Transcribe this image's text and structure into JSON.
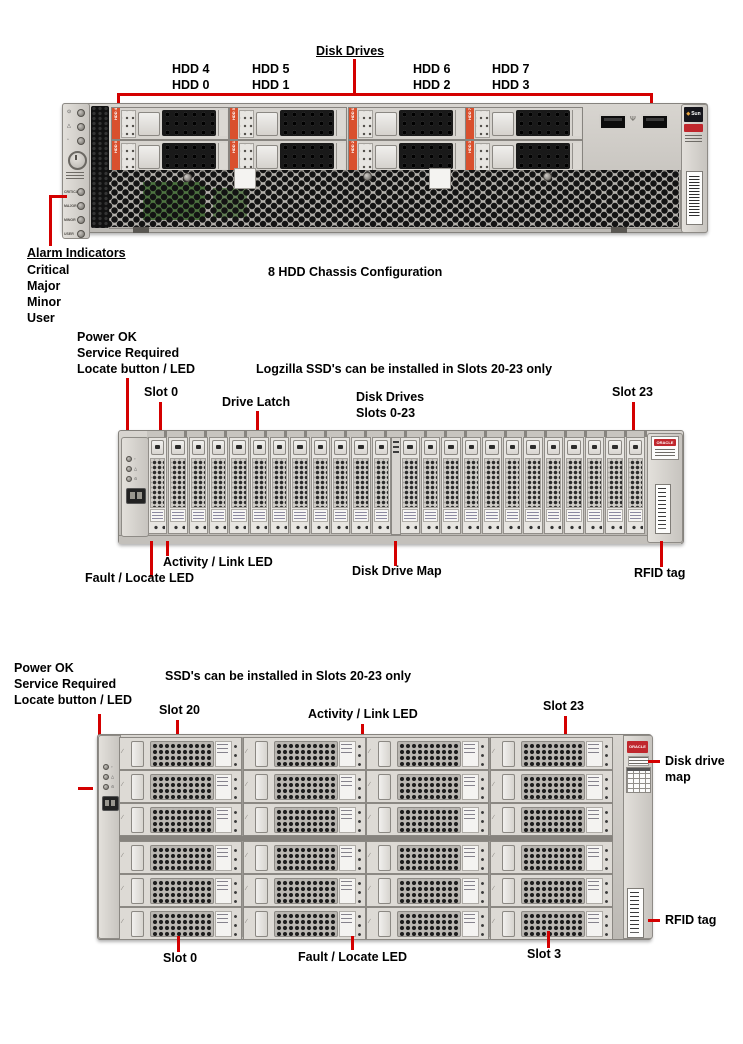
{
  "palette": {
    "leader_red": "#d40000",
    "orange_slot_tag": "#d9502e",
    "oracle_red": "#c0272d",
    "chassis_grey": "#c9c6c1"
  },
  "top": {
    "title": "Disk Drives",
    "hdd_top": [
      "HDD 4",
      "HDD 5",
      "HDD 6",
      "HDD 7"
    ],
    "hdd_bottom": [
      "HDD 0",
      "HDD 1",
      "HDD 2",
      "HDD 3"
    ],
    "caption": "8 HDD Chassis Configuration",
    "alarm_heading": "Alarm Indicators",
    "alarm_items": [
      "Critical",
      "Major",
      "Minor",
      "User"
    ],
    "ear_led_labels": [
      "CRITICAL",
      "MAJOR",
      "MINOR",
      "USER"
    ],
    "sun_badge": "Sun"
  },
  "middle": {
    "power_ok": "Power OK",
    "service_required": "Service Required",
    "locate": "Locate button / LED",
    "note": "Logzilla SSD's can be installed in Slots 20-23 only",
    "slot0": "Slot 0",
    "drive_latch": "Drive Latch",
    "disk_drives_line1": "Disk Drives",
    "disk_drives_line2": "Slots 0-23",
    "slot23": "Slot 23",
    "activity": "Activity / Link LED",
    "fault": "Fault / Locate LED",
    "map": "Disk Drive Map",
    "rfid": "RFID tag",
    "oracle_badge": "ORACLE",
    "slot_count": 24
  },
  "bottom": {
    "power_ok": "Power OK",
    "service_required": "Service Required",
    "locate": "Locate button / LED",
    "note": "SSD's can be installed in Slots 20-23 only",
    "slot20": "Slot 20",
    "activity": "Activity / Link LED",
    "slot23": "Slot 23",
    "map_line1": "Disk drive",
    "map_line2": "map",
    "rfid": "RFID tag",
    "slot0": "Slot 0",
    "fault": "Fault / Locate LED",
    "slot3": "Slot 3",
    "oracle_badge": "ORACLE",
    "rows": 6,
    "cols": 4
  }
}
